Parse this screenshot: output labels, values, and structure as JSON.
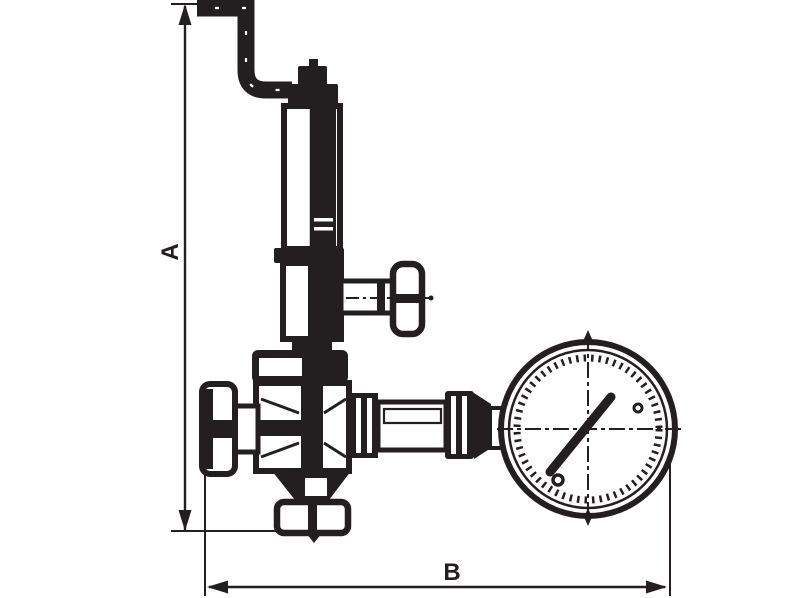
{
  "diagram": {
    "kind": "technical line drawing",
    "subject": "pressure regulator valve with relief pipe, shut-off handles and pressure gauge",
    "colors": {
      "line": "#231f20",
      "background": "#ffffff"
    },
    "dimension_labels": {
      "vertical": "A",
      "horizontal": "B"
    }
  }
}
